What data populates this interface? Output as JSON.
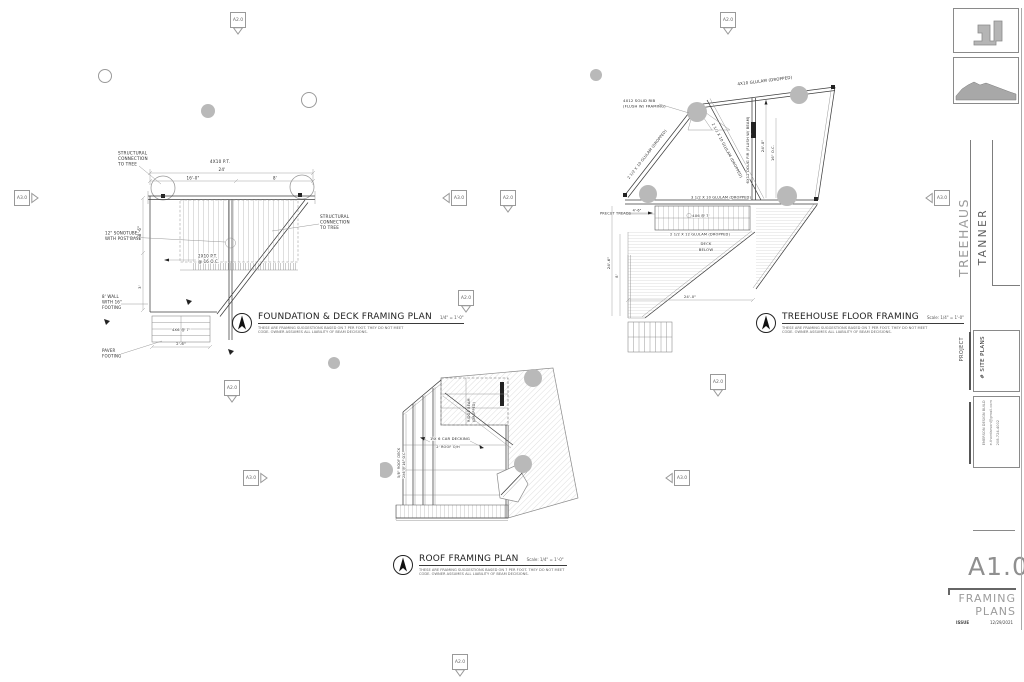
{
  "colors": {
    "line": "#3d3d3d",
    "muted": "#9a9a9a",
    "tree_fill": "#b9b9b9",
    "sheet_bg": "#ffffff"
  },
  "shared": {
    "disclaimer1": "THESE ARE FRAMING SUGGESTIONS BASED ON 7 PER FOOT. THEY DO NOT MEET",
    "disclaimer2": "CODE. OWNER ASSUMES ALL LIABILITY OF BEAM DECISIONS."
  },
  "foundation": {
    "title": "FOUNDATION & DECK FRAMING PLAN",
    "scale": "1/4\" = 1'-0\"",
    "labels": {
      "conn_l1": "STRUCTURAL",
      "conn_l2": "CONNECTION",
      "conn_l3": "TO TREE",
      "beam_top": "4X10 P.T.",
      "dim_total": "24'",
      "dim_a": "16'-0\"",
      "dim_b": "8'",
      "dim_left": "8'-6\"",
      "dim_left2": "3'",
      "dim_bot": "2'-6\"",
      "sono_l1": "12\" SONOTUBE",
      "sono_l2": "WITH POST BASE",
      "joist_l1": "2X10 P.T.",
      "joist_l2": "@ 16 O.C.",
      "wall_l1": "8' WALL",
      "wall_l2": "WITH 16\"",
      "wall_l3": "FOOTING",
      "paver_l1": "PAVER",
      "paver_l2": "FOOTING",
      "stair": "4X6 @ 7'"
    }
  },
  "treehouse": {
    "title": "TREEHOUSE FLOOR FRAMING",
    "scale": "Scale:  1/4\" = 1'-0\"",
    "labels": {
      "glulam_top": "4X10 GLULAM (DROPPED)",
      "rib_l1": "4X12 SOLID RIB",
      "rib_l2": "(FLUSH W/ FRAMING)",
      "glulam_diag": "2 1/2 X 10 GLULAM (DROPPED)",
      "beam_center": "6X12 DOUG FIR (FLUSH W/ BEAM)",
      "dim_v1": "24'-0\"",
      "dim_v2": "16\" O.C.",
      "band_top": "3 1/2 X 10 GLULAM (DROPPED)",
      "stair": "4X6 @ 7'",
      "band_bot": "2 1/2 X 12 GLULAM (DROPPED)",
      "precut": "PRECUT TREADS",
      "deck_l1": "DECK",
      "deck_l2": "BELOW",
      "dim_left": "24'-6\"",
      "dim_left2": "8'",
      "dim_bot": "24'-0\"",
      "dim_top_small": "4'-6\""
    }
  },
  "roof": {
    "title": "ROOF FRAMING PLAN",
    "scale": "Scale:  1/4\" = 1'-0\"",
    "labels": {
      "deck_l1": "1 X 6 CAR DECKING",
      "deck_l2": "2' ROOF O/H",
      "left_l1": "5/8\" ROOF DECK",
      "left_l2": "2X6 @ 16\" O.C.",
      "ridge_l1": "RIDGE BEAM",
      "ridge_l2": "(DROPPED)"
    }
  },
  "titleblock": {
    "project_name": "TREEHAUS",
    "client_name": "TANNER",
    "project_label": "PROJECT",
    "project_value": "# SITE PLANS",
    "firm_l1": "EMERSON DESIGN BUILD",
    "firm_l2": "e.thordarson@gmail.com",
    "firm_l3": "208-724-4002",
    "sheet_number": "A1.0",
    "sheet_title_l1": "FRAMING",
    "sheet_title_l2": "PLANS",
    "issue_label": "ISSUE",
    "date": "12/29/2021"
  },
  "markers": [
    {
      "x": 230,
      "y": 12,
      "dir": "down",
      "label": "A2.0"
    },
    {
      "x": 720,
      "y": 12,
      "dir": "down",
      "label": "A2.0"
    },
    {
      "x": 14,
      "y": 190,
      "dir": "right",
      "label": "A3.0"
    },
    {
      "x": 451,
      "y": 190,
      "dir": "left",
      "label": "A3.0"
    },
    {
      "x": 500,
      "y": 190,
      "dir": "down",
      "label": "A2.0"
    },
    {
      "x": 458,
      "y": 290,
      "dir": "down",
      "label": "A2.0"
    },
    {
      "x": 934,
      "y": 190,
      "dir": "left",
      "label": "A3.0"
    },
    {
      "x": 224,
      "y": 380,
      "dir": "down",
      "label": "A2.0"
    },
    {
      "x": 710,
      "y": 374,
      "dir": "down",
      "label": "A2.0"
    },
    {
      "x": 243,
      "y": 470,
      "dir": "right",
      "label": "A3.0"
    },
    {
      "x": 674,
      "y": 470,
      "dir": "left",
      "label": "A3.0"
    },
    {
      "x": 452,
      "y": 654,
      "dir": "down",
      "label": "A2.0"
    }
  ],
  "trees": [
    {
      "x": 104,
      "y": 75,
      "r": 6,
      "filled": false
    },
    {
      "x": 208,
      "y": 111,
      "r": 7,
      "filled": true
    },
    {
      "x": 308,
      "y": 99,
      "r": 7,
      "filled": false
    },
    {
      "x": 596,
      "y": 75,
      "r": 6,
      "filled": true
    },
    {
      "x": 334,
      "y": 363,
      "r": 6,
      "filled": true
    }
  ]
}
